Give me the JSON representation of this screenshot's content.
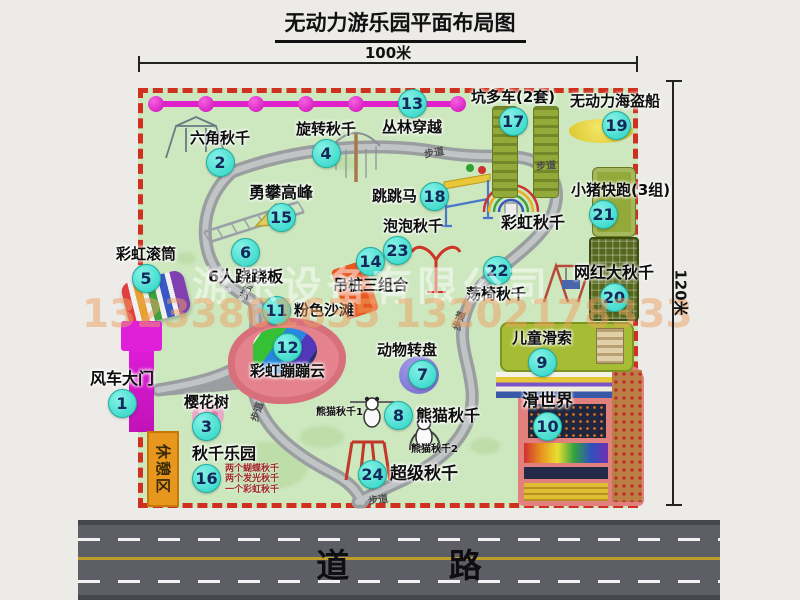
{
  "title": "无动力游乐园平面布局图",
  "dimensions": {
    "width": "100米",
    "height": "120米"
  },
  "watermark": {
    "company": "游乐设备有限公司",
    "phone": "13233861635 13202178333"
  },
  "road": {
    "label": "道 路"
  },
  "park": {
    "rest_area": "休憩区",
    "path_label": "步道",
    "rainbow_swing_label": "彩虹秋千",
    "panda_sub1": "熊猫秋千1",
    "panda_sub2": "熊猫秋千2",
    "items": {
      "i1": {
        "num": "1",
        "label": "风车大门"
      },
      "i2": {
        "num": "2",
        "label": "六角秋千"
      },
      "i3": {
        "num": "3",
        "label": "樱花树"
      },
      "i4": {
        "num": "4",
        "label": "旋转秋千"
      },
      "i5": {
        "num": "5",
        "label": "彩虹滚筒"
      },
      "i6": {
        "num": "6",
        "label": "6人跷跷板"
      },
      "i7": {
        "num": "7",
        "label": "动物转盘"
      },
      "i8": {
        "num": "8",
        "label": "熊猫秋千"
      },
      "i9": {
        "num": "9",
        "label": "儿童滑索"
      },
      "i10": {
        "num": "10",
        "label": "滑世界"
      },
      "i11": {
        "num": "11",
        "label": "粉色沙滩"
      },
      "i12": {
        "num": "12",
        "label": "彩虹蹦蹦云"
      },
      "i13": {
        "num": "13",
        "label": "丛林穿越"
      },
      "i14": {
        "num": "14",
        "label": "吊桩三组合"
      },
      "i15": {
        "num": "15",
        "label": "勇攀高峰"
      },
      "i16": {
        "num": "16",
        "label": "秋千乐园",
        "notes": [
          "两个蝴蝶秋千",
          "两个发光秋千",
          "一个彩虹秋千"
        ]
      },
      "i17": {
        "num": "17",
        "label": "坑多车(2套)"
      },
      "i18": {
        "num": "18",
        "label": "跳跳马"
      },
      "i19": {
        "num": "19",
        "label": "无动力海盗船"
      },
      "i20": {
        "num": "20",
        "label": "网红大秋千"
      },
      "i21": {
        "num": "21",
        "label": "小猪快跑(3组)"
      },
      "i22": {
        "num": "22",
        "label": "荡椅秋千"
      },
      "i23": {
        "num": "23",
        "label": "泡泡秋千"
      },
      "i24": {
        "num": "24",
        "label": "超级秋千"
      }
    }
  }
}
